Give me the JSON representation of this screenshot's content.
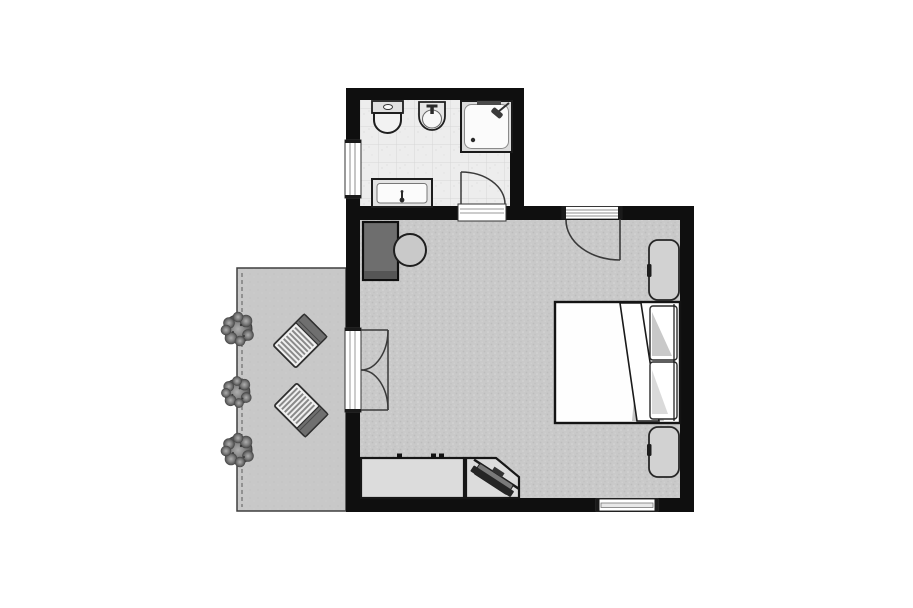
{
  "colors": {
    "background": "#ffffff",
    "wall": "#0f0f0f",
    "bedroom_carpet": "#c9c9c9",
    "bathroom_tile": "#ededed",
    "terrace_deck": "#c8c8c8",
    "linen_white": "#fefefe",
    "wardrobe_dark": "#6e6e6e",
    "stool_gray": "#c9c9c9",
    "nightstand_gray": "#d2d2d2",
    "counter_gray": "#dcdcdc",
    "tv_black": "#252525",
    "lounger_cushion": "#6f6f6f",
    "fixture_white": "#f7f7f7",
    "door_line": "#3a3a3a"
  },
  "rooms": {
    "bathroom": {
      "name": "bathroom",
      "fixtures": {
        "toilet": "toilet",
        "bidet": "bidet",
        "shower": "shower",
        "vanity": "vanity-sink",
        "window": "bathroom-window",
        "door": "bathroom-door"
      }
    },
    "bedroom": {
      "name": "bedroom",
      "fixtures": {
        "wardrobe": "wardrobe-unit",
        "stool": "round-stool",
        "bed": "double-bed",
        "pillow_top": "pillow",
        "pillow_bottom": "pillow",
        "nightstand_top": "nightstand-bench",
        "nightstand_bottom": "nightstand-bench",
        "counter": "dresser-counter",
        "tv": "corner-tv-stand",
        "entry": "entry-door",
        "french": "french-doors",
        "window": "bedroom-window"
      }
    },
    "terrace": {
      "name": "terrace",
      "fixtures": {
        "chair1": "lounge-chair",
        "chair2": "lounge-chair",
        "shrub1": "shrub",
        "shrub2": "shrub",
        "shrub3": "shrub"
      }
    }
  }
}
